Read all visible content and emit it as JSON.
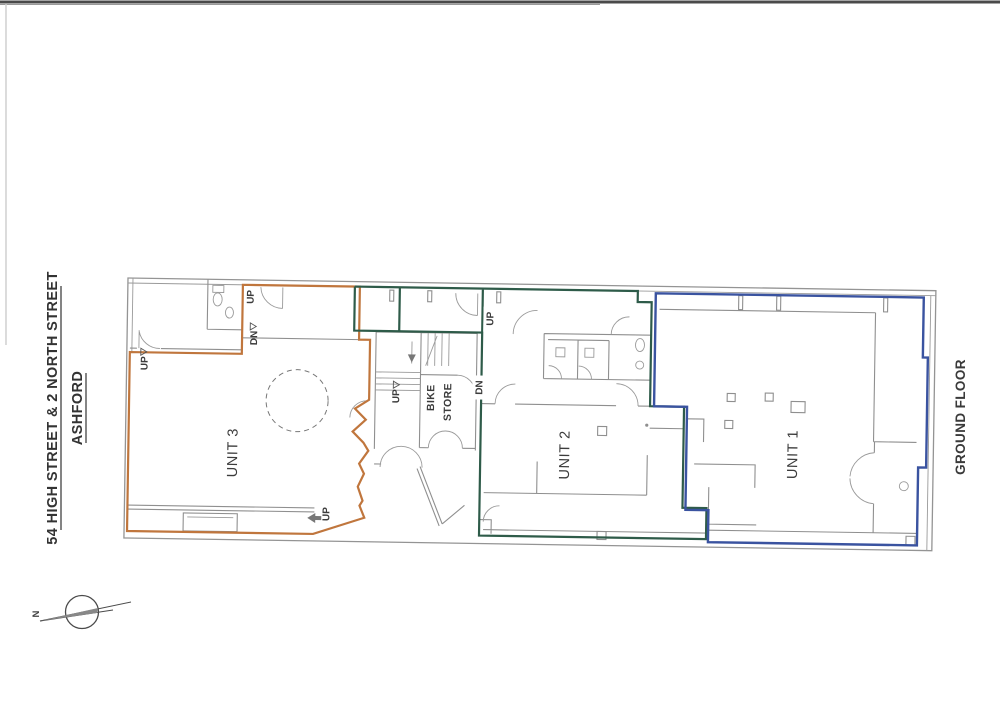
{
  "document": {
    "type": "architectural floor plan (scanned)",
    "floor_label": "GROUND FLOOR"
  },
  "title_block": {
    "address": "54 HIGH STREET & 2 NORTH STREET",
    "town": "ASHFORD"
  },
  "units": [
    {
      "label": "UNIT 1",
      "boundary_color": "#3a53a0"
    },
    {
      "label": "UNIT 2",
      "boundary_color": "#2e5b49"
    },
    {
      "label": "UNIT 3",
      "boundary_color": "#c0763d"
    }
  ],
  "rooms": {
    "bike_store_line1": "BIKE",
    "bike_store_line2": "STORE"
  },
  "stair_labels": {
    "up": "UP",
    "down": "DN"
  },
  "compass": {
    "north": "N"
  },
  "colors": {
    "walls": "#949494",
    "interior_walls": "#8f8f8f",
    "text": "#3a3a3a",
    "paper": "#ffffff",
    "scan_edge": "#4a4a4a"
  }
}
